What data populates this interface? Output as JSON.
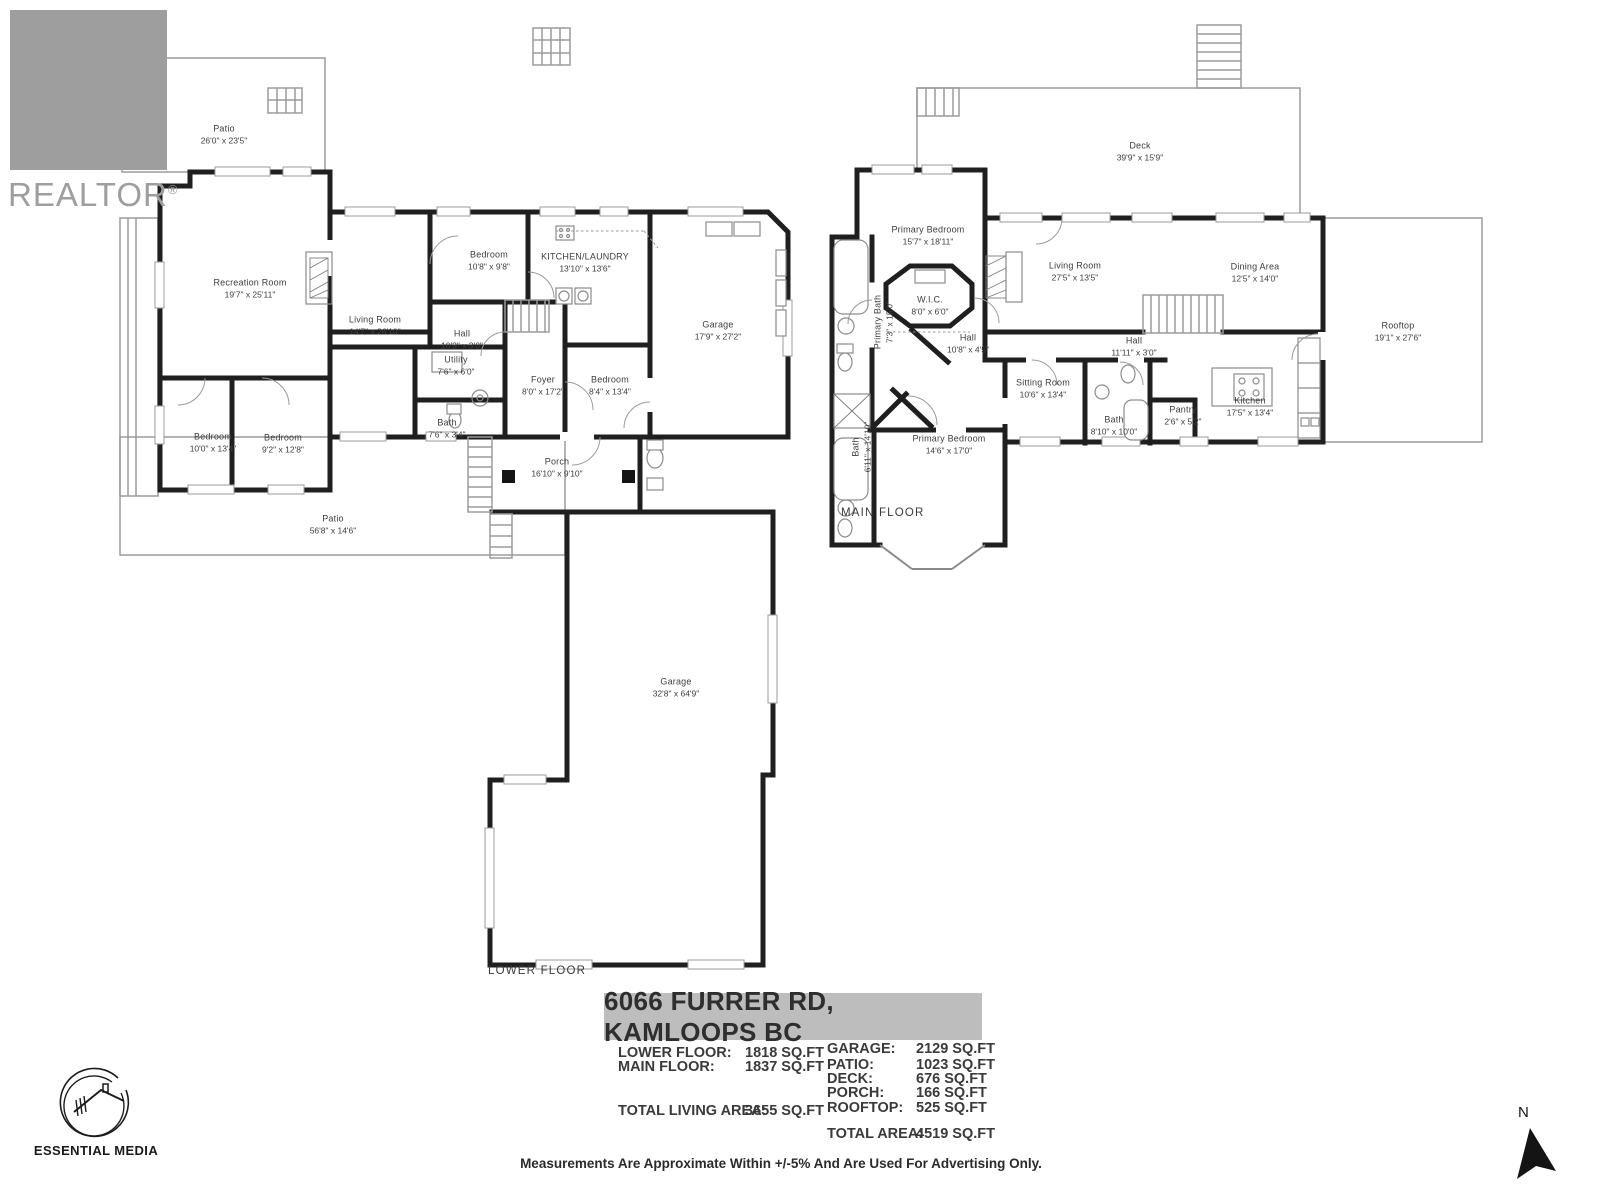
{
  "branding": {
    "realtor_wordmark": "REALTOR",
    "registered_mark": "®",
    "realtor_letter": "R",
    "media_credit": "ESSENTIAL MEDIA",
    "compass_north": "N"
  },
  "colors": {
    "wall": "#1f1f1f",
    "thin_outline": "#9b9b9b",
    "banner_gray": "#bdbdbd",
    "logo_gray": "#9e9e9e",
    "text": "#3d3d3d"
  },
  "floors": {
    "lower": {
      "label": "LOWER FLOOR",
      "rooms": [
        {
          "name": "Patio",
          "dims": "26'0\" x 23'5\""
        },
        {
          "name": "Recreation Room",
          "dims": "19'7\" x 25'11\""
        },
        {
          "name": "Living Room",
          "dims": "14'7\" x 26'10\""
        },
        {
          "name": "Bedroom",
          "dims": "10'8\" x 9'8\""
        },
        {
          "name": "KITCHEN/LAUNDRY",
          "dims": "13'10\" x 13'6\""
        },
        {
          "name": "Garage",
          "dims": "17'9\" x 27'2\""
        },
        {
          "name": "Hall",
          "dims": "10'3\" x 3'0\""
        },
        {
          "name": "Utility",
          "dims": "7'6\" x 6'0\""
        },
        {
          "name": "Bath",
          "dims": "7'6\" x 3'4\""
        },
        {
          "name": "Foyer",
          "dims": "8'0\" x 17'2\""
        },
        {
          "name": "Bedroom",
          "dims": "8'4\" x 13'4\""
        },
        {
          "name": "Bedroom",
          "dims": "10'0\" x 13'4\""
        },
        {
          "name": "Bedroom",
          "dims": "9'2\" x 12'8\""
        },
        {
          "name": "Porch",
          "dims": "16'10\" x 9'10\""
        },
        {
          "name": "Patio",
          "dims": "56'8\" x 14'6\""
        },
        {
          "name": "Garage",
          "dims": "32'8\" x 64'9\""
        }
      ]
    },
    "main": {
      "label": "MAIN FLOOR",
      "rooms": [
        {
          "name": "Deck",
          "dims": "39'9\" x 15'9\""
        },
        {
          "name": "Primary Bedroom",
          "dims": "15'7\" x 18'11\""
        },
        {
          "name": "Primary Bath",
          "dims": "7'3\" x 15'0\""
        },
        {
          "name": "W.I.C.",
          "dims": "8'0\" x 6'0\""
        },
        {
          "name": "Hall",
          "dims": "10'8\" x 4'5\""
        },
        {
          "name": "Living Room",
          "dims": "27'5\" x 13'5\""
        },
        {
          "name": "Dining Area",
          "dims": "12'5\" x 14'0\""
        },
        {
          "name": "Rooftop",
          "dims": "19'1\" x 27'6\""
        },
        {
          "name": "Hall",
          "dims": "11'11\" x 3'0\""
        },
        {
          "name": "Sitting Room",
          "dims": "10'6\" x 13'4\""
        },
        {
          "name": "Bath",
          "dims": "8'10\" x 10'0\""
        },
        {
          "name": "Pantry",
          "dims": "2'6\" x 5'2\""
        },
        {
          "name": "Kitchen",
          "dims": "17'5\" x 13'4\""
        },
        {
          "name": "Bath",
          "dims": "6'11\" x 14'10\""
        },
        {
          "name": "Primary Bedroom",
          "dims": "14'6\" x 17'0\""
        }
      ]
    }
  },
  "summary": {
    "address": "6066 FURRER RD, KAMLOOPS BC",
    "left": [
      {
        "label": "LOWER FLOOR:",
        "value": "1818 SQ.FT"
      },
      {
        "label": "MAIN FLOOR:",
        "value": "1837 SQ.FT"
      },
      {
        "label": "TOTAL LIVING AREA:",
        "value": "3655 SQ.FT"
      }
    ],
    "right": [
      {
        "label": "GARAGE:",
        "value": "2129 SQ.FT"
      },
      {
        "label": "PATIO:",
        "value": "1023 SQ.FT"
      },
      {
        "label": "DECK:",
        "value": "676 SQ.FT"
      },
      {
        "label": "PORCH:",
        "value": "166 SQ.FT"
      },
      {
        "label": "ROOFTOP:",
        "value": "525 SQ.FT"
      },
      {
        "label": "TOTAL AREA:",
        "value": "4519 SQ.FT"
      }
    ]
  },
  "disclaimer": "Measurements Are Approximate Within +/-5% And Are Used For Advertising Only."
}
